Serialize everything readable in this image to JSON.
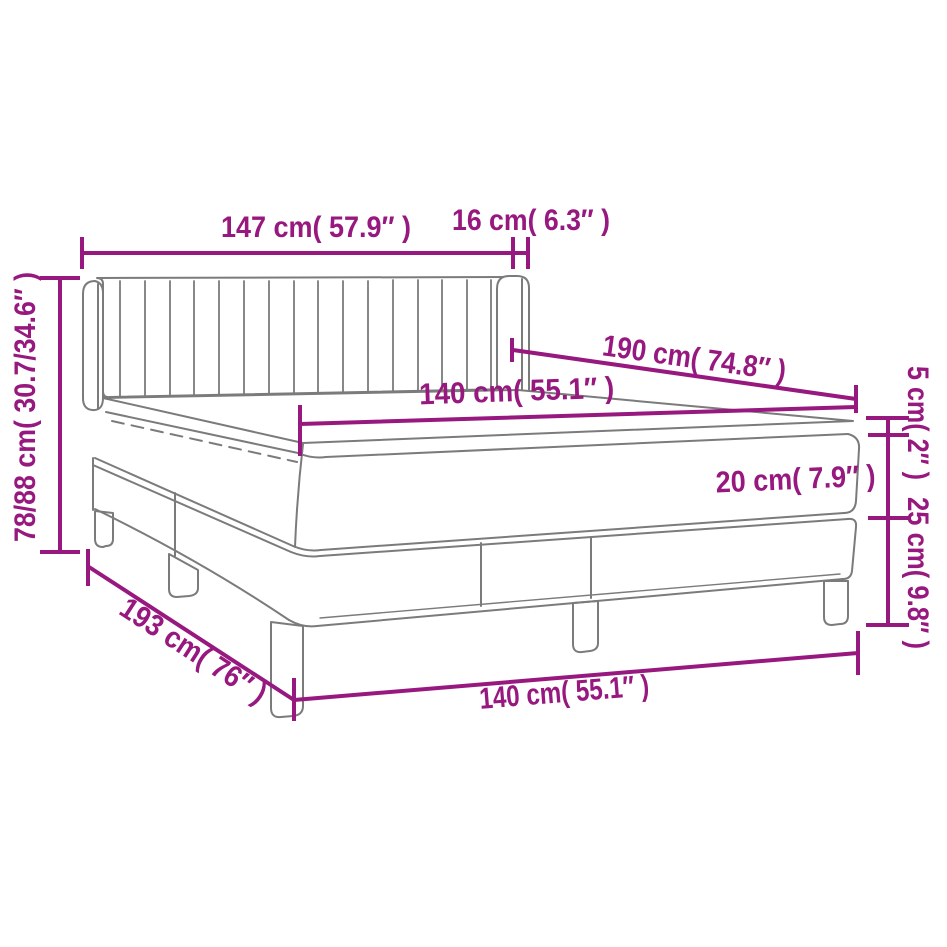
{
  "figure": {
    "type": "product dimension diagram",
    "subject": "box spring bed with headboard, mattress and topper"
  },
  "colors": {
    "dimension": "#97187e",
    "drawing": "#7b7b7b",
    "background": "#ffffff"
  },
  "labels": {
    "headboard_width": "147 cm( 57.9″ )",
    "wing_depth": "16 cm( 6.3″ )",
    "headboard_height": "78/88 cm( 30.7/34.6″ )",
    "bed_length": "190 cm( 74.8″ )",
    "mattress_width": "140 cm( 55.1″ )",
    "topper_thickness": "5 cm( 2″ )",
    "mattress_thickness": "20 cm( 7.9″ )",
    "base_height": "25 cm( 9.8″ )",
    "total_length": "193 cm( 76″ )",
    "base_width": "140 cm( 55.1″ )"
  }
}
